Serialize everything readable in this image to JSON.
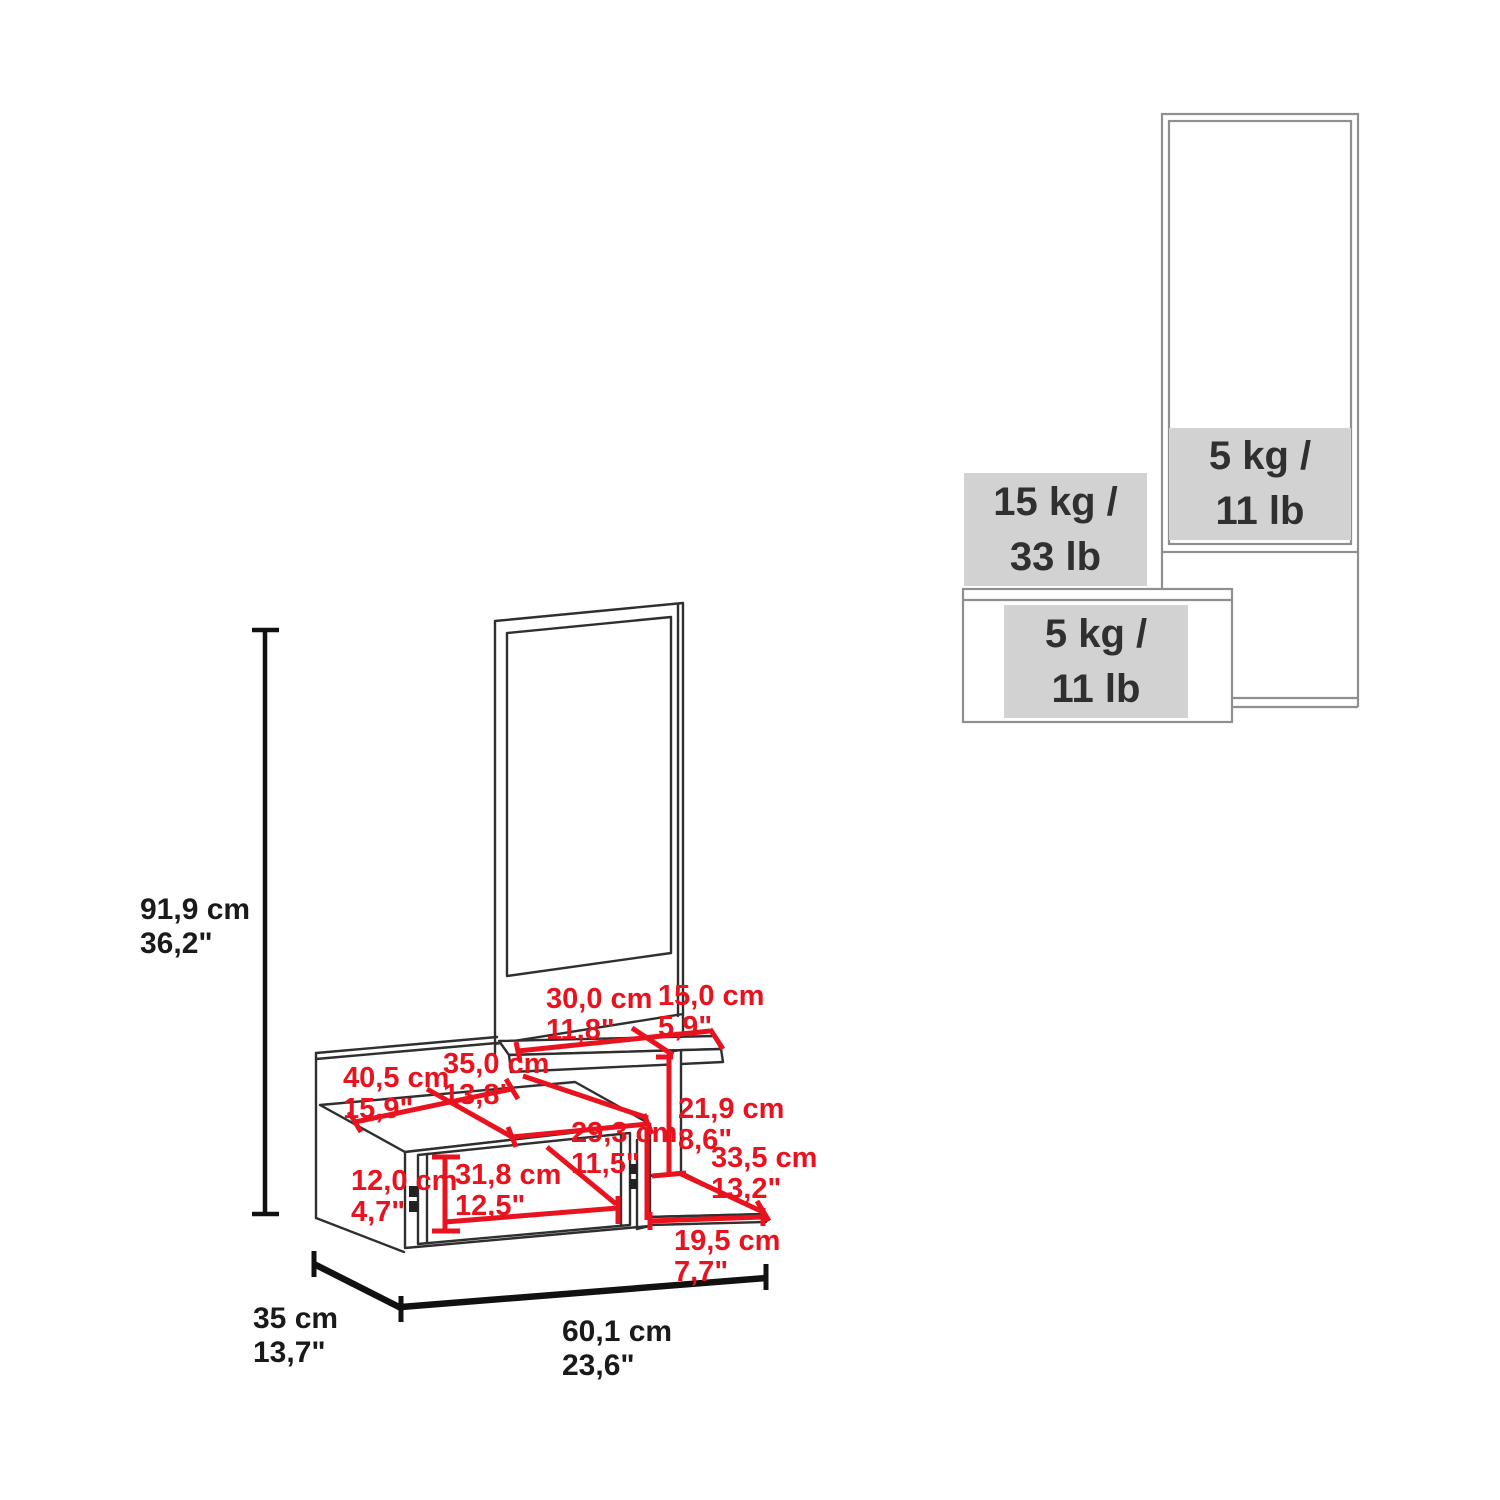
{
  "left_diagram": {
    "height": {
      "cm": "91,9 cm",
      "in": "36,2\""
    },
    "depth": {
      "cm": "35 cm",
      "in": "13,7\""
    },
    "width": {
      "cm": "60,1 cm",
      "in": "23,6\""
    },
    "red_dims": {
      "shelf_left": {
        "cm": "30,0 cm",
        "in": "11,8\""
      },
      "shelf_right": {
        "cm": "15,0 cm",
        "in": "5,9\""
      },
      "top_depth": {
        "cm": "35,0 cm",
        "in": "13,8\""
      },
      "top_width": {
        "cm": "40,5 cm",
        "in": "15,9\""
      },
      "support_height": {
        "cm": "21,9 cm",
        "in": "8,6\""
      },
      "niche_width": {
        "cm": "29,3 cm",
        "in": "11,5\""
      },
      "lower_shelf_depth": {
        "cm": "33,5 cm",
        "in": "13,2\""
      },
      "drawer_width": {
        "cm": "31,8 cm",
        "in": "12,5\""
      },
      "drawer_height": {
        "cm": "12,0 cm",
        "in": "4,7\""
      },
      "lower_shelf_width": {
        "cm": "19,5 cm",
        "in": "7,7\""
      }
    }
  },
  "right_diagram": {
    "mirror_capacity": {
      "l1": "5 kg /",
      "l2": "11 lb"
    },
    "shelf_capacity": {
      "l1": "15 kg /",
      "l2": "33 lb"
    },
    "drawer_capacity": {
      "l1": "5 kg /",
      "l2": "11 lb"
    }
  },
  "colors": {
    "dimension_red": "#e8131f",
    "drawing_line_dark": "#2f2f2f",
    "drawing_line_gray": "#8f8f8f",
    "capacity_box_gray": "#d2d2d2",
    "text_black": "#1a1a1a"
  }
}
